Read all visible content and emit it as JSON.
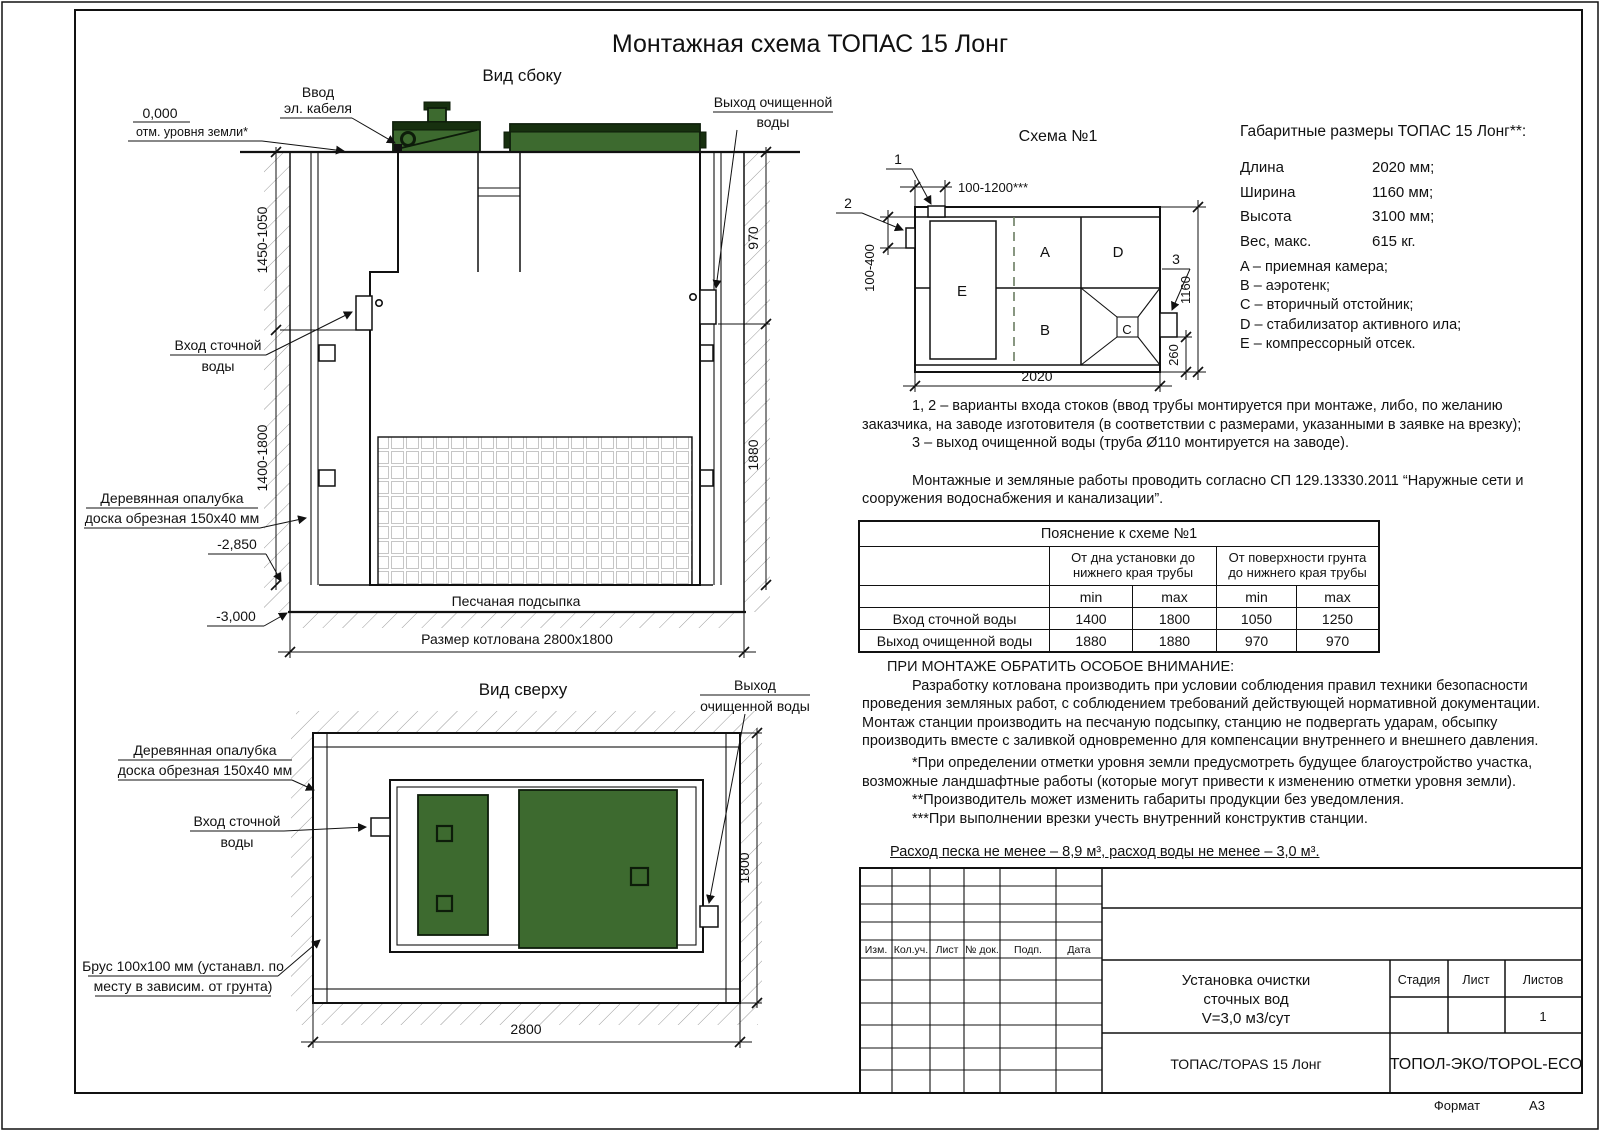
{
  "title": "Монтажная схема ТОПАС 15 Лонг",
  "colors": {
    "lid_green": "#3d6a2f",
    "lid_dark": "#17300f"
  },
  "side_view": {
    "title": "Вид сбоку",
    "labels": {
      "zero": "0,000",
      "zero_sub": "отм. уровня земли*",
      "cable": [
        "Ввод",
        "эл. кабеля"
      ],
      "outlet": [
        "Выход очищенной",
        "воды"
      ],
      "inlet": [
        "Вход сточной",
        "воды"
      ],
      "formwork": [
        "Деревянная опалубка",
        "доска обрезная 150х40 мм"
      ],
      "sand": "Песчаная подсыпка",
      "pit": "Размер котлована 2800х1800",
      "lvl1": "-2,850",
      "lvl2": "-3,000"
    },
    "dims": {
      "inlet_depth": "1450-1050",
      "body_depth": "1400-1800",
      "outlet_depth": "970",
      "outlet_bottom": "1880"
    }
  },
  "top_view": {
    "title": "Вид сверху",
    "labels": {
      "outlet": [
        "Выход",
        "очищенной воды"
      ],
      "formwork": [
        "Деревянная опалубка",
        "доска обрезная 150х40 мм"
      ],
      "inlet": [
        "Вход сточной",
        "воды"
      ],
      "beam": [
        "Брус 100х100 мм (устанавл. по",
        "месту в зависим. от грунта)"
      ]
    },
    "dims": {
      "width": "2800",
      "depth": "1800"
    }
  },
  "schema": {
    "title": "Схема №1",
    "markers": [
      "1",
      "2",
      "3"
    ],
    "compartments": [
      "A",
      "B",
      "C",
      "D",
      "E"
    ],
    "dims": {
      "top": "100-1200***",
      "left": "100-400",
      "height": "1160",
      "outlet": "260",
      "length": "2020"
    }
  },
  "specs": {
    "heading": "Габаритные размеры ТОПАС 15 Лонг**:",
    "rows": [
      {
        "label": "Длина",
        "value": "2020 мм;"
      },
      {
        "label": "Ширина",
        "value": "1160 мм;"
      },
      {
        "label": "Высота",
        "value": "3100 мм;"
      },
      {
        "label": "Вес, макс.",
        "value": "615 кг."
      }
    ],
    "legend": [
      "A – приемная камера;",
      "B – аэротенк;",
      "C – вторичный отстойник;",
      "D – стабилизатор активного ила;",
      "E – компрессорный отсек."
    ]
  },
  "notes": {
    "p1": "1, 2 – варианты входа  стоков (ввод трубы монтируется при монтаже, либо, по желанию заказчика, на заводе изготовителя (в соответствии с размерами, указанными в заявке на врезку);",
    "p2": "3 – выход очищенной воды (труба Ø110 монтируется на заводе).",
    "p3": "Монтажные и земляные работы проводить согласно СП 129.13330.2011 “Наружные сети и сооружения водоснабжения и канализации”."
  },
  "table": {
    "title": "Пояснение к схеме №1",
    "group1": "От дна установки до нижнего края трубы",
    "group2": "От поверхности грунта до нижнего края трубы",
    "min": "min",
    "max": "max",
    "rows": [
      {
        "name": "Вход сточной воды",
        "v": [
          "1400",
          "1800",
          "1050",
          "1250"
        ]
      },
      {
        "name": "Выход очищенной воды",
        "v": [
          "1880",
          "1880",
          "970",
          "970"
        ]
      }
    ]
  },
  "attention": {
    "heading": "ПРИ МОНТАЖЕ ОБРАТИТЬ ОСОБОЕ ВНИМАНИЕ:",
    "body": "Разработку котлована производить при условии соблюдения правил техники безопасности проведения земляных работ, с соблюдением требований действующей нормативной документации. Монтаж станции производить на песчаную подсыпку, станцию не подвергать ударам, обсыпку производить вместе с заливкой одновременно для компенсации внутреннего и внешнего давления.",
    "f1": "*При определении отметки уровня земли предусмотреть будущее благоустройство участка, возможные ландшафтные работы (которые могут привести к изменению отметки уровня земли).",
    "f2": "**Производитель может изменить габариты продукции без уведомления.",
    "f3": "***При выполнении врезки учесть внутренний конструктив станции.",
    "consumption": "Расход песка не менее – 8,9 м³, расход воды не менее – 3,0 м³."
  },
  "title_block": {
    "cols": [
      "Изм.",
      "Кол.уч.",
      "Лист",
      "№ док.",
      "Подп.",
      "Дата"
    ],
    "doc_title": [
      "Установка очистки",
      "сточных вод",
      "V=3,0 м3/сут"
    ],
    "stage": "Стадия",
    "sheet": "Лист",
    "sheets": "Листов",
    "sheets_value": "1",
    "product": "ТОПАС/TOPAS 15 Лонг",
    "company": "ТОПОЛ-ЭКО/TOPOL-ECO",
    "format_label": "Формат",
    "format_value": "A3"
  }
}
